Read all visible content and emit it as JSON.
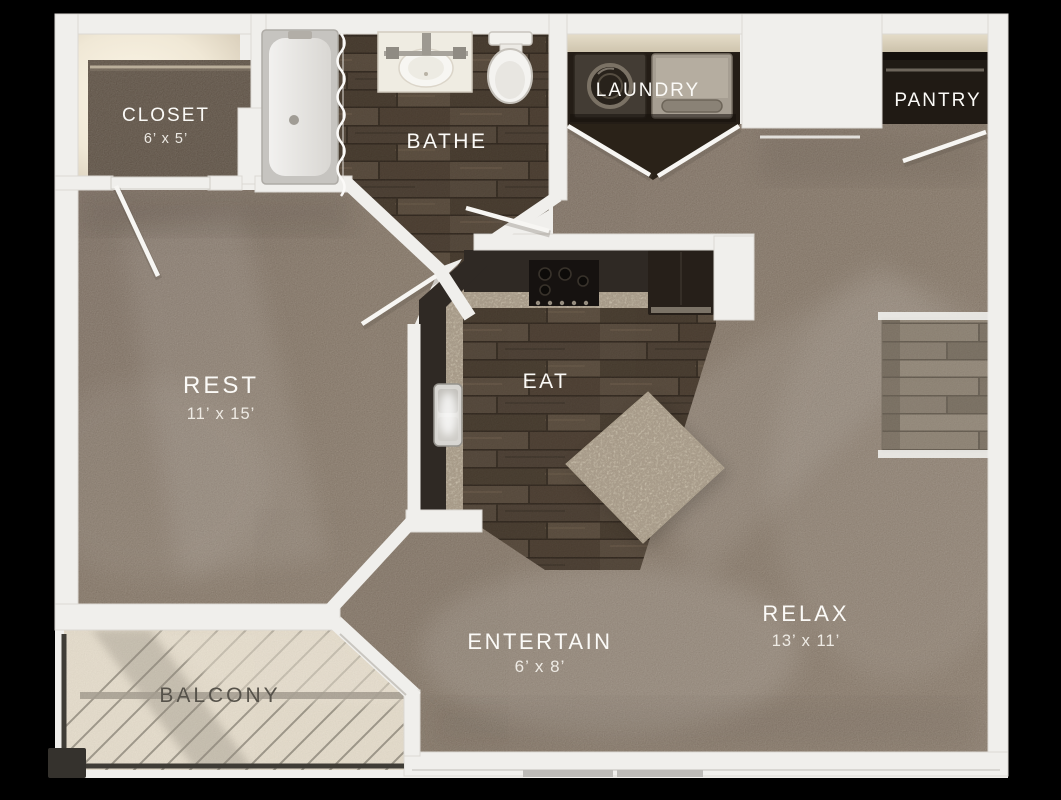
{
  "rooms": {
    "closet": {
      "label": "CLOSET",
      "dims": "6’ x 5’"
    },
    "bathe": {
      "label": "BATHE"
    },
    "laundry": {
      "label": "LAUNDRY"
    },
    "pantry": {
      "label": "PANTRY"
    },
    "rest": {
      "label": "REST",
      "dims": "11’ x 15’"
    },
    "eat": {
      "label": "EAT"
    },
    "entertain": {
      "label": "ENTERTAIN",
      "dims": "6’ x 8’"
    },
    "relax": {
      "label": "RELAX",
      "dims": "13’ x 11’"
    },
    "balcony": {
      "label": "BALCONY"
    }
  },
  "colors": {
    "background": "#000000",
    "wall": "#f0efec",
    "carpet": "#8b7d6d",
    "closet_carpet": "#5d5144",
    "wood_floor": "#4e4236",
    "entry_wood": "#8d8375",
    "counter": "#2f2924",
    "granite": "#d3c9b4",
    "balcony_floor": "#ebe3d2",
    "balcony_text": "#56524a",
    "label_text": "#fbfaf7"
  },
  "fixtures": [
    "bathtub",
    "shower-curtain",
    "vanity-sink",
    "toilet",
    "washer",
    "dryer",
    "laundry-double-doors",
    "pantry-shelf",
    "stove",
    "refrigerator",
    "kitchen-sink",
    "kitchen-island",
    "sliding-glass-door",
    "balcony-railing",
    "door-swing"
  ]
}
